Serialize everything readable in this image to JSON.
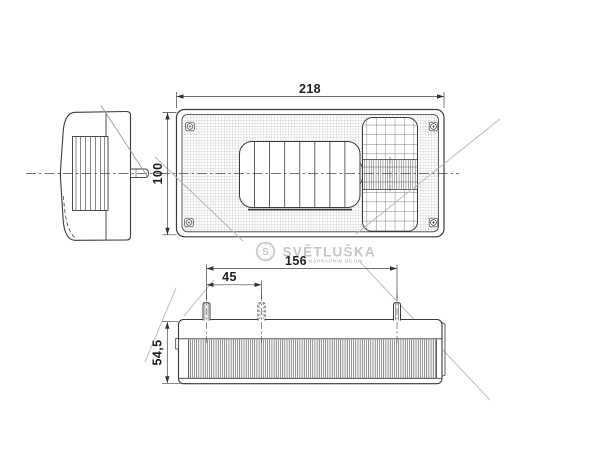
{
  "drawing": {
    "dims": {
      "front_width": "218",
      "front_height": "100",
      "stud_span": "156",
      "stud_offset": "45",
      "body_depth": "54,5"
    },
    "watermark": {
      "brand": "SVĚTLUŠKA",
      "logo_letter": "S",
      "tagline": "K NÁHRADNÍM DÍLŮM"
    },
    "colors": {
      "line": "#3c3c3c",
      "dim_line": "#444444",
      "dim_text": "#1f1f1f",
      "watermark_gray": "#c6c6c6",
      "diagonal_gray": "#b5b5b5",
      "background": "#ffffff"
    }
  }
}
